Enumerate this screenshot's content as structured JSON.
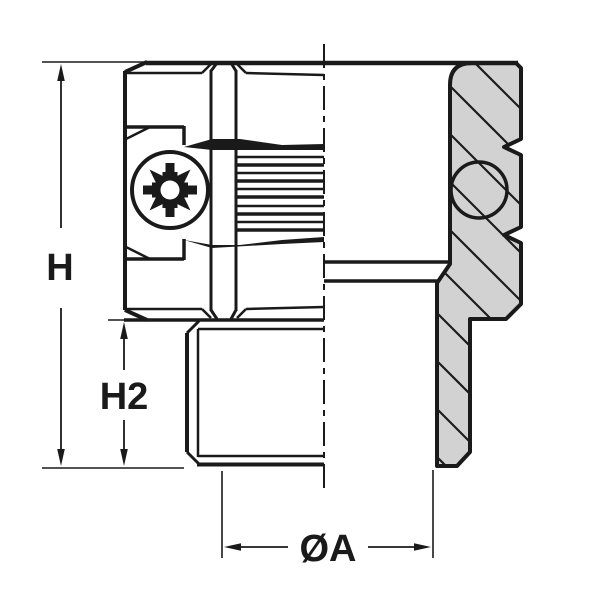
{
  "drawing": {
    "kind": "technical-drawing",
    "description": "Half-section engineering drawing of a serrated threaded insert / sleeve fitting with Pozidriv screw, exterior view on left half, hatched cross-section on right half",
    "view": "front elevation, half section",
    "dimensions": {
      "overall_height": {
        "label": "H"
      },
      "lower_section_height": {
        "label": "H2"
      },
      "diameter": {
        "label": "ØA"
      }
    },
    "icons": {
      "screw_drive": "pozidriv-screw-head",
      "centerline": "dash-dot-centerline",
      "section_marker": "diagonal-hatching"
    },
    "colors": {
      "line": "#1a1a1a",
      "hatch_fill": "#d2d2d2",
      "background": "#ffffff"
    }
  }
}
